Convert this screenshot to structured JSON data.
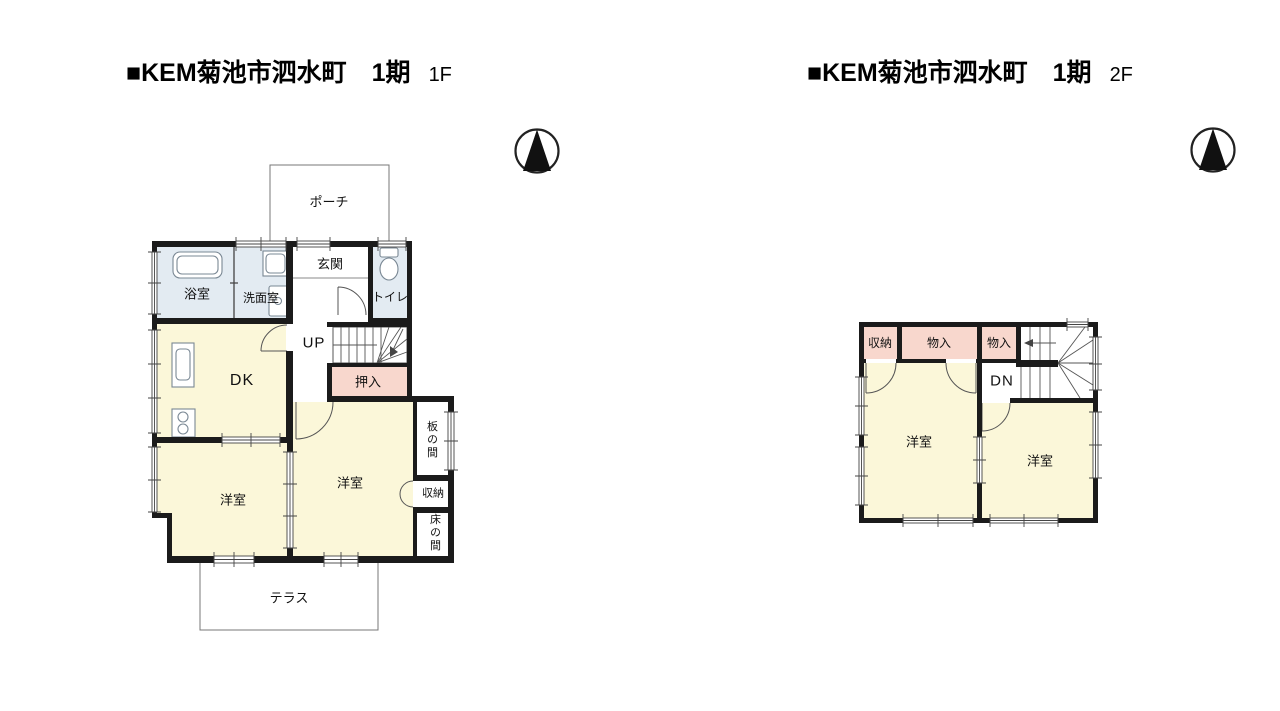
{
  "palette": {
    "wall": "#1b1b1b",
    "yellow": "#FBF7D9",
    "pink": "#F8D7CD",
    "blue": "#E3EBF2",
    "ink": "#111111"
  },
  "header_left": {
    "title": "■KEM菊池市泗水町　1期",
    "floor": "1F"
  },
  "header_right": {
    "title": "■KEM菊池市泗水町　1期",
    "floor": "2F"
  },
  "plan1f": {
    "porch": "ポーチ",
    "genkan": "玄関",
    "bath": "浴室",
    "washroom": "洗面室",
    "toilet": "トイレ",
    "stairs_label": "UP",
    "oshiire": "押入",
    "dk": "DK",
    "room_left": "洋室",
    "room_right": "洋室",
    "itanoma": "板の間",
    "storage": "収納",
    "tokonoma": "床の間",
    "terrace": "テラス"
  },
  "plan2f": {
    "storage": "収納",
    "monoire_1": "物入",
    "monoire_2": "物入",
    "stairs_label": "DN",
    "room_left": "洋室",
    "room_right": "洋室"
  }
}
